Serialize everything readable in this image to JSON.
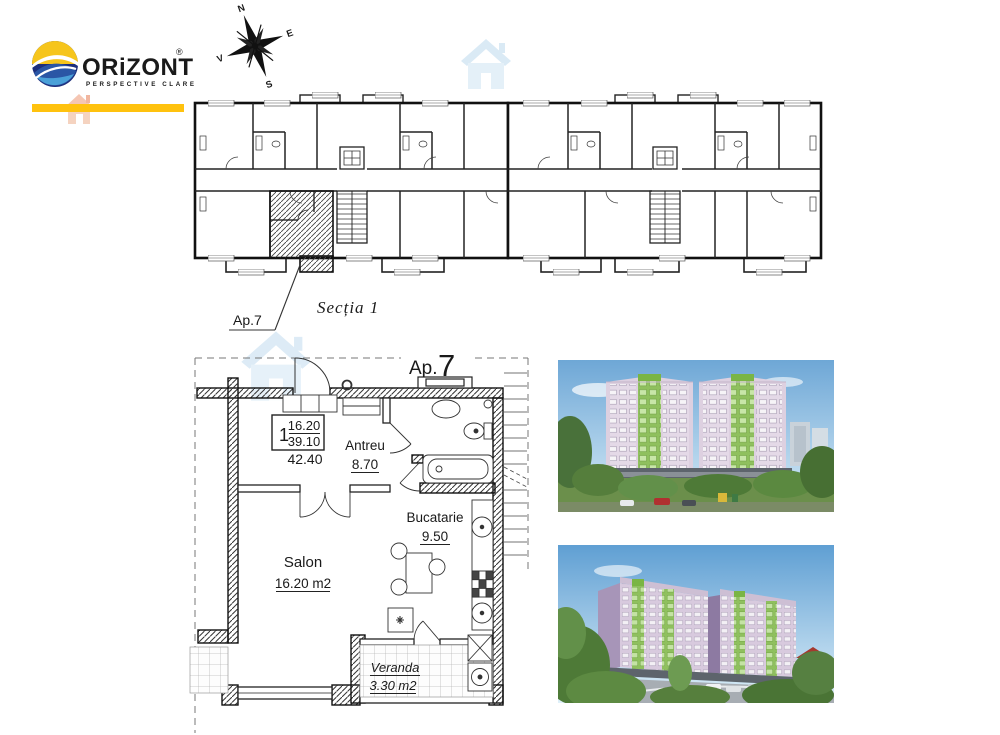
{
  "brand": {
    "name": "ORiZONT",
    "reg": "®",
    "tagline": "PERSPECTIVE CLARE"
  },
  "compass": {
    "n": "N",
    "e": "E",
    "s": "S",
    "w": "V"
  },
  "overview": {
    "section_label": "Secția 1",
    "apartment_callout": "Ap.7"
  },
  "detail": {
    "title_prefix": "Ap.",
    "title_number": "7",
    "area_table": {
      "rooms_count": "1",
      "living_area": "16.20",
      "usable_area": "39.10",
      "total_area": "42.40"
    },
    "rooms": {
      "antreu": {
        "name": "Antreu",
        "area": "8.70"
      },
      "bucatarie": {
        "name": "Bucatarie",
        "area": "9.50"
      },
      "salon": {
        "name": "Salon",
        "area": "16.20 m2"
      },
      "veranda": {
        "name": "Veranda",
        "area": "3.30 m2"
      }
    }
  },
  "colors": {
    "brand_navy": "#232a77",
    "brand_yellow": "#ffc20e",
    "watermark_blue": "#cfe5f4",
    "watermark_orange": "#e8996f",
    "plan_ink": "#1a1a1a",
    "facade_pink": "#d9cbdd",
    "facade_side": "#b3a2c2",
    "balcony_green": "#8fc05e",
    "sky_blue": "#7ab0d9",
    "tree_green": "#4e7a37"
  }
}
